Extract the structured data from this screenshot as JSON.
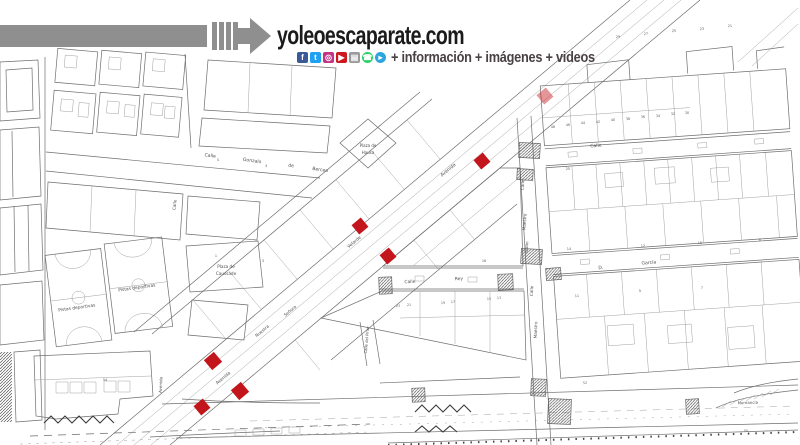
{
  "header": {
    "title": "yoleoescaparate.com",
    "tagline": "+ información + imágenes + videos",
    "colors": {
      "accent_gray": "#8f8f8f",
      "title": "#1b1b1b",
      "tagline": "#4a4145"
    },
    "social": [
      {
        "name": "facebook-icon",
        "glyph": "f",
        "bg": "#3b5998",
        "shape": "square"
      },
      {
        "name": "twitter-icon",
        "glyph": "t",
        "bg": "#1da1f2",
        "shape": "square"
      },
      {
        "name": "instagram-icon",
        "glyph": "◎",
        "bg": "#c13584",
        "shape": "square"
      },
      {
        "name": "youtube-icon",
        "glyph": "▶",
        "bg": "#cc181e",
        "shape": "square"
      },
      {
        "name": "gallery-icon",
        "glyph": "▤",
        "bg": "#9a9a9a",
        "shape": "square"
      },
      {
        "name": "whatsapp-icon",
        "glyph": "☎",
        "bg": "#25d366",
        "shape": "circle"
      },
      {
        "name": "telegram-icon",
        "glyph": "▸",
        "bg": "#2ca5e0",
        "shape": "circle"
      }
    ]
  },
  "map": {
    "line_color": "#6e6e6e",
    "label_color": "#4f4f4f",
    "marker_color": "#c3161c",
    "labels": [
      {
        "t": "Calle",
        "x": 210,
        "y": 157,
        "r": 8,
        "s": 4.6
      },
      {
        "t": "Gonzalo",
        "x": 252,
        "y": 162,
        "r": 8,
        "s": 4.6
      },
      {
        "t": "de",
        "x": 291,
        "y": 167,
        "r": 8,
        "s": 4.6
      },
      {
        "t": "Berceo",
        "x": 320,
        "y": 171,
        "r": 8,
        "s": 4.6
      },
      {
        "t": "Plaza de",
        "x": 368,
        "y": 147,
        "r": 0,
        "s": 4.0
      },
      {
        "t": "Hausa",
        "x": 368,
        "y": 154,
        "r": 0,
        "s": 4.0
      },
      {
        "t": "Calle",
        "x": 176,
        "y": 205,
        "r": -85,
        "s": 4.2
      },
      {
        "t": "Plaza de",
        "x": 226,
        "y": 268,
        "r": 0,
        "s": 4.2
      },
      {
        "t": "Caussade",
        "x": 226,
        "y": 275,
        "r": 0,
        "s": 4.2
      },
      {
        "t": "Pistas deportivas",
        "x": 77,
        "y": 309,
        "r": -8,
        "s": 4.4
      },
      {
        "t": "Pistas deportivas",
        "x": 137,
        "y": 289,
        "r": -8,
        "s": 4.4
      },
      {
        "t": "Avenida",
        "x": 449,
        "y": 171,
        "r": -40,
        "s": 4.6
      },
      {
        "t": "Velarde",
        "x": 355,
        "y": 243,
        "r": -40,
        "s": 4.4
      },
      {
        "t": "Nuestra",
        "x": 263,
        "y": 332,
        "r": -40,
        "s": 4.2
      },
      {
        "t": "Señora",
        "x": 291,
        "y": 312,
        "r": -40,
        "s": 4.2
      },
      {
        "t": "Avenida",
        "x": 224,
        "y": 379,
        "r": -40,
        "s": 4.4
      },
      {
        "t": "Avenida",
        "x": 162,
        "y": 385,
        "r": -87,
        "s": 4.0
      },
      {
        "t": "Calle del Pinar",
        "x": 368,
        "y": 340,
        "r": -85,
        "s": 3.8
      },
      {
        "t": "Calle",
        "x": 524,
        "y": 185,
        "r": -86,
        "s": 4.2
      },
      {
        "t": "Maestro",
        "x": 526,
        "y": 222,
        "r": -86,
        "s": 4.2
      },
      {
        "t": "Odón",
        "x": 528,
        "y": 247,
        "r": -86,
        "s": 4.2
      },
      {
        "t": "Calle",
        "x": 596,
        "y": 147,
        "r": -5,
        "s": 4.6
      },
      {
        "t": "Calle",
        "x": 410,
        "y": 283,
        "r": -3,
        "s": 4.4
      },
      {
        "t": "Rey",
        "x": 459,
        "y": 280,
        "r": -3,
        "s": 4.4
      },
      {
        "t": "D.",
        "x": 601,
        "y": 269,
        "r": -5,
        "s": 4.6
      },
      {
        "t": "García",
        "x": 649,
        "y": 264,
        "r": -5,
        "s": 4.6
      },
      {
        "t": "Calle",
        "x": 533,
        "y": 291,
        "r": -88,
        "s": 4.2
      },
      {
        "t": "Maestro",
        "x": 537,
        "y": 330,
        "r": -88,
        "s": 4.2
      },
      {
        "t": "Numancia",
        "x": 748,
        "y": 404,
        "r": -2,
        "s": 4.0
      }
    ],
    "numbers": [
      {
        "t": "48",
        "x": 553,
        "y": 128,
        "r": -4
      },
      {
        "t": "46",
        "x": 568,
        "y": 126,
        "r": -4
      },
      {
        "t": "44",
        "x": 583,
        "y": 124,
        "r": -4
      },
      {
        "t": "42",
        "x": 598,
        "y": 123,
        "r": -4
      },
      {
        "t": "40",
        "x": 613,
        "y": 121,
        "r": -4
      },
      {
        "t": "38",
        "x": 628,
        "y": 120,
        "r": -4
      },
      {
        "t": "36",
        "x": 643,
        "y": 118,
        "r": -4
      },
      {
        "t": "34",
        "x": 658,
        "y": 117,
        "r": -4
      },
      {
        "t": "32",
        "x": 673,
        "y": 115,
        "r": -4
      },
      {
        "t": "30",
        "x": 687,
        "y": 114,
        "r": -4
      },
      {
        "t": "25",
        "x": 568,
        "y": 170,
        "r": -4
      },
      {
        "t": "14",
        "x": 569,
        "y": 250,
        "r": -4
      },
      {
        "t": "12",
        "x": 643,
        "y": 247,
        "r": -4
      },
      {
        "t": "10",
        "x": 700,
        "y": 244,
        "r": -4
      },
      {
        "t": "8",
        "x": 760,
        "y": 241,
        "r": -4
      },
      {
        "t": "11",
        "x": 577,
        "y": 297,
        "r": -4
      },
      {
        "t": "9",
        "x": 640,
        "y": 292,
        "r": -4
      },
      {
        "t": "7",
        "x": 702,
        "y": 289,
        "r": -4
      },
      {
        "t": "23",
        "x": 398,
        "y": 307,
        "r": -2
      },
      {
        "t": "21",
        "x": 409,
        "y": 306,
        "r": -2
      },
      {
        "t": "19",
        "x": 443,
        "y": 304,
        "r": -2
      },
      {
        "t": "17",
        "x": 453,
        "y": 303,
        "r": -2
      },
      {
        "t": "15",
        "x": 489,
        "y": 300,
        "r": -2
      },
      {
        "t": "13",
        "x": 499,
        "y": 299,
        "r": -2
      },
      {
        "t": "16",
        "x": 484,
        "y": 262,
        "r": 0
      },
      {
        "t": "5",
        "x": 218,
        "y": 161,
        "r": 8
      },
      {
        "t": "3",
        "x": 266,
        "y": 167,
        "r": 8
      },
      {
        "t": "1",
        "x": 216,
        "y": 257,
        "r": 0
      },
      {
        "t": "3",
        "x": 263,
        "y": 262,
        "r": 0
      },
      {
        "t": "54",
        "x": 105,
        "y": 381,
        "r": 0
      },
      {
        "t": "52",
        "x": 585,
        "y": 384,
        "r": -2
      },
      {
        "t": "55",
        "x": 746,
        "y": 432,
        "r": -2
      },
      {
        "t": "29",
        "x": 618,
        "y": 38,
        "r": -4
      },
      {
        "t": "27",
        "x": 646,
        "y": 35,
        "r": -4
      },
      {
        "t": "25",
        "x": 674,
        "y": 32,
        "r": -4
      },
      {
        "t": "23",
        "x": 702,
        "y": 30,
        "r": -4
      },
      {
        "t": "21",
        "x": 730,
        "y": 27,
        "r": -4
      }
    ],
    "markers": [
      {
        "x": 545,
        "y": 96,
        "s": 12,
        "r": -40,
        "o": 0.45
      },
      {
        "x": 482,
        "y": 161,
        "s": 12,
        "r": -40,
        "o": 1
      },
      {
        "x": 360,
        "y": 226,
        "s": 12,
        "r": -40,
        "o": 1
      },
      {
        "x": 388,
        "y": 256,
        "s": 12,
        "r": -40,
        "o": 1
      },
      {
        "x": 213,
        "y": 361,
        "s": 13,
        "r": -40,
        "o": 1
      },
      {
        "x": 240,
        "y": 391,
        "s": 13,
        "r": -40,
        "o": 1
      },
      {
        "x": 202,
        "y": 407,
        "s": 12,
        "r": -40,
        "o": 1
      }
    ],
    "crosswalks": [
      {
        "x": 519,
        "y": 143,
        "w": 21,
        "h": 15,
        "r": 3
      },
      {
        "x": 517,
        "y": 169,
        "w": 16,
        "h": 11,
        "r": 3
      },
      {
        "x": 521,
        "y": 249,
        "w": 21,
        "h": 15,
        "r": 3
      },
      {
        "x": 546,
        "y": 268,
        "w": 15,
        "h": 12,
        "r": -4
      },
      {
        "x": 379,
        "y": 277,
        "w": 13,
        "h": 17,
        "r": -2
      },
      {
        "x": 498,
        "y": 274,
        "w": 15,
        "h": 16,
        "r": -2
      },
      {
        "x": 531,
        "y": 379,
        "w": 15,
        "h": 17,
        "r": 2
      },
      {
        "x": 548,
        "y": 399,
        "w": 23,
        "h": 25,
        "r": 2
      },
      {
        "x": 686,
        "y": 399,
        "w": 13,
        "h": 15,
        "r": -3
      },
      {
        "x": 412,
        "y": 388,
        "w": 13,
        "h": 14,
        "r": -2
      }
    ]
  }
}
